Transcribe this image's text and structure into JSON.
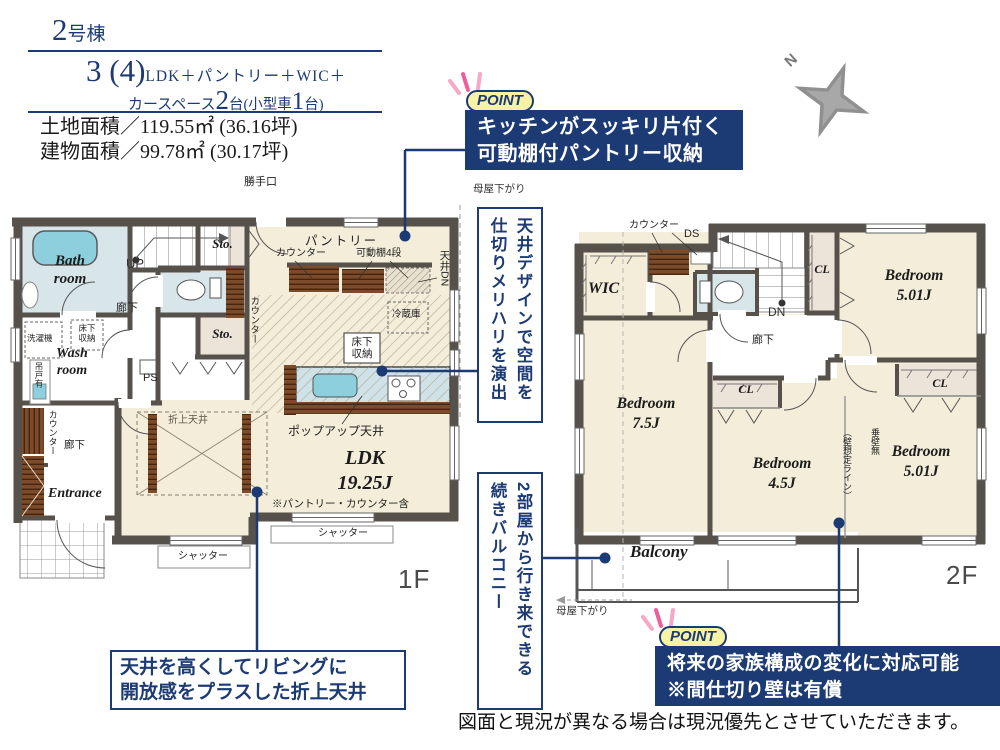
{
  "colors": {
    "navy": "#1c3a74",
    "badge_yellow": "#f8f2a4",
    "pink": "#ee5f9a",
    "wall": "#57514c",
    "floor_cream": "#f3edd9",
    "floor_blue": "#d8e5e9",
    "floor_beige": "#ece3d9",
    "wood": "#7b4b2a",
    "water_blue": "#8ecfdd",
    "compass_gray": "#909090"
  },
  "header": {
    "unit_number": "2",
    "unit_suffix": "号棟",
    "plan_big": "3 (4)",
    "plan_rest": "LDK＋パントリー＋WIC＋",
    "car_text1": "カースペース",
    "car_num1": "2",
    "car_text2": "台(小型車",
    "car_num2": "1",
    "car_text3": "台)",
    "land_area": "土地面積／119.55㎡ (36.16坪)",
    "building_area": "建物面積／99.78㎡ (30.17坪)"
  },
  "points": {
    "badge": "POINT",
    "p1_line1": "キッチンがスッキリ片付く",
    "p1_line2": "可動棚付パントリー収納",
    "p2_line1": "将来の家族構成の変化に対応可能",
    "p2_line2": "※間仕切り壁は有償"
  },
  "callouts": {
    "ceiling_col1": "天井デザインで空間を",
    "ceiling_col2": "仕切りメリハリを演出",
    "balcony_col1": "2部屋から行き来できる",
    "balcony_col2": "続きバルコニー",
    "coffered_line1": "天井を高くしてリビングに",
    "coffered_line2": "開放感をプラスした折上天井"
  },
  "floor1": {
    "label": "1F",
    "back_door": "勝手口",
    "pantry": "パントリー",
    "counter": "カウンター",
    "shelf": "可動棚4段",
    "ceiling_dn": "天井DN",
    "fridge": "冷蔵庫",
    "underfloor": "床下\n収納",
    "up": "UP",
    "sto": "Sto.",
    "hallway": "廊下",
    "washer": "洗濯機",
    "wash_room": "Wash\nroom",
    "bath_room": "Bath\nroom",
    "hanging_door": "吊戸有",
    "ps": "PS",
    "popup_ceiling": "ポップアップ天井",
    "ldk": "LDK\n19.25J",
    "ldk_note": "※パントリー・カウンター含",
    "coffered_ceiling": "折上天井",
    "shutter": "シャッター",
    "entrance": "Entrance",
    "moya": "母屋下がり"
  },
  "floor2": {
    "label": "2F",
    "counter": "カウンター",
    "ds": "DS",
    "wic": "WIC",
    "cl": "CL",
    "dn": "DN",
    "hallway": "廊下",
    "bedroom_a": "Bedroom\n5.01J",
    "bedroom_b": "Bedroom\n7.5J",
    "bedroom_c": "Bedroom\n4.5J",
    "bedroom_d": "Bedroom\n5.01J",
    "wall_note_a": "垂壁無",
    "wall_note_b": "（壁想定ライン）",
    "balcony": "Balcony",
    "moya": "母屋下がり"
  },
  "footer": {
    "disclaimer": "図面と現況が異なる場合は現況優先とさせていただきます。"
  },
  "compass": {
    "north": "N"
  }
}
